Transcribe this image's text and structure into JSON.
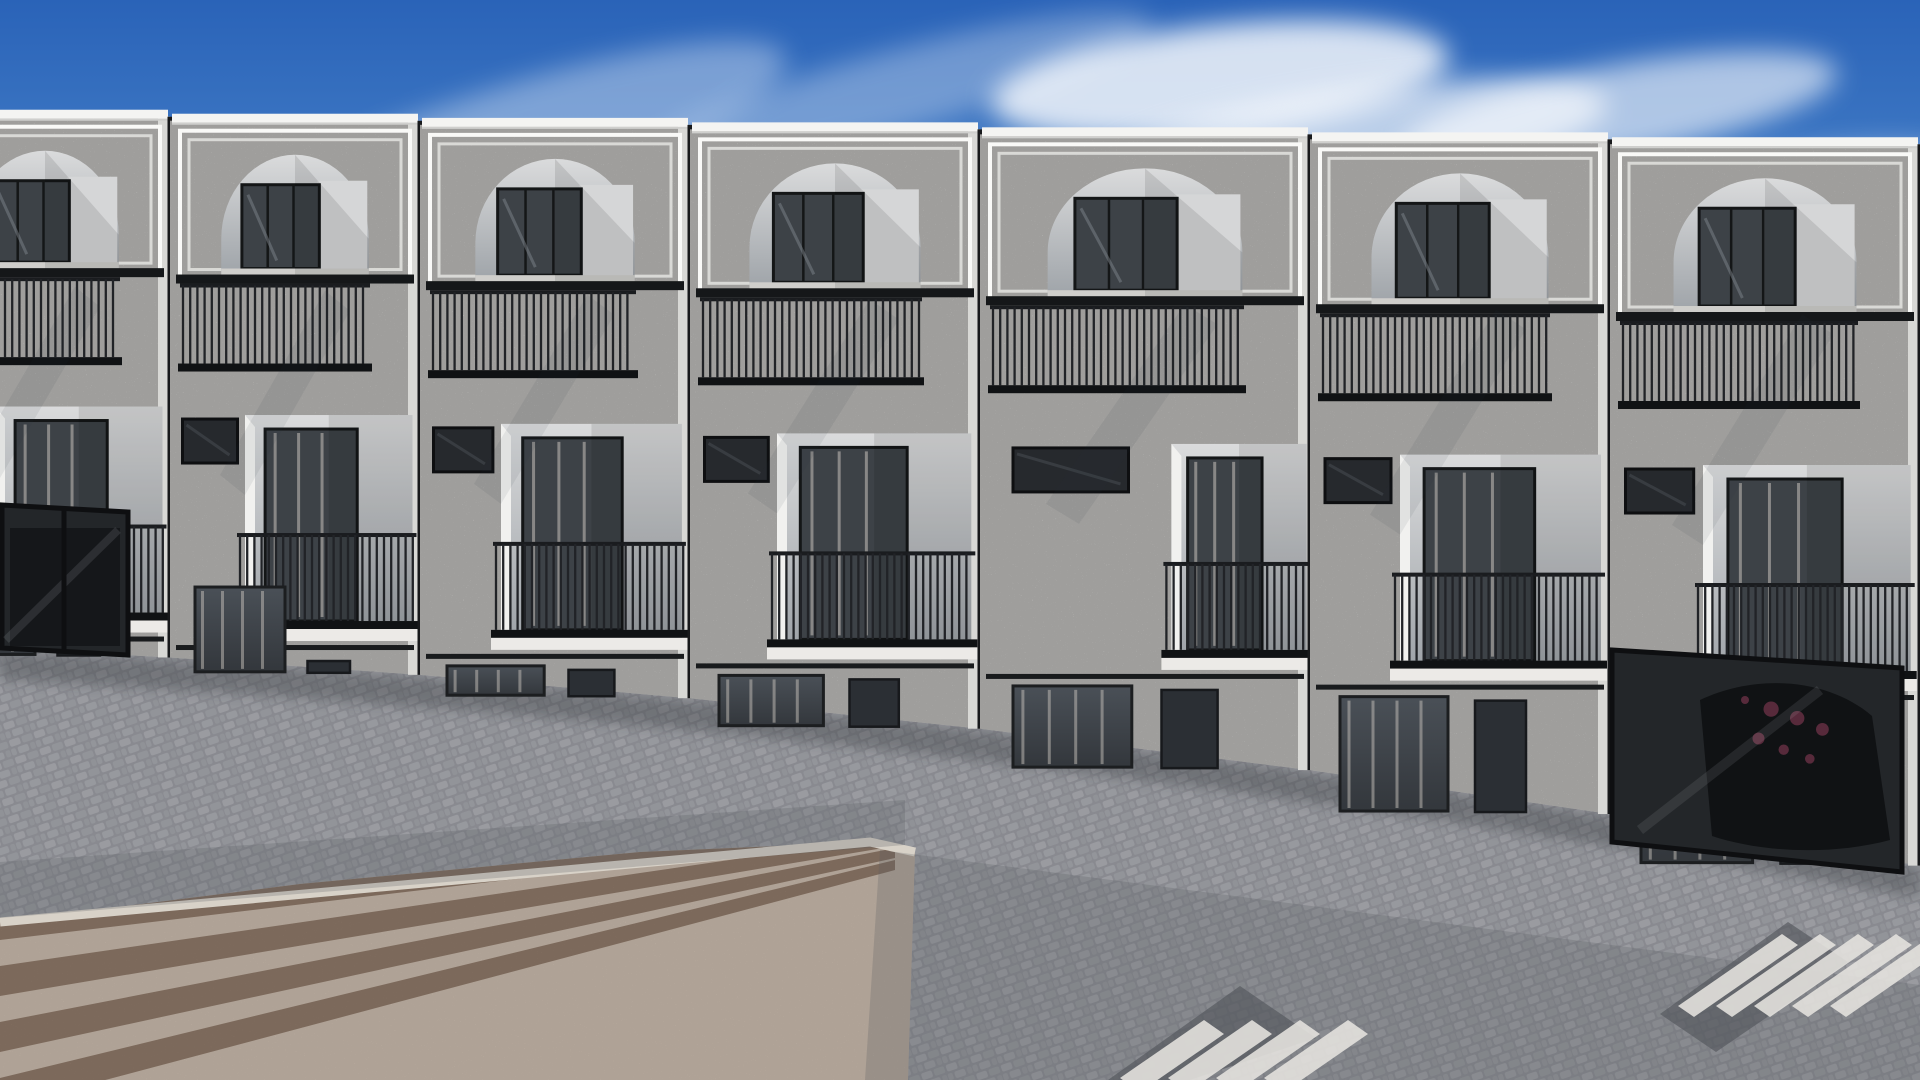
{
  "scene": {
    "description": "Aerial 3D architectural rendering: a row of white Mediterranean-style townhouses with arched roof terraces, black balcony railings, pink flowering trees, street lamps, parked cars, a cyclist and pedestrians on a paved street",
    "width": 1920,
    "height": 1080
  },
  "palette": {
    "sky_top": "#2a63b8",
    "sky_mid": "#4f8ace",
    "sky_horizon": "#a5c9ea",
    "cloud": "#ffffff",
    "facade": "#efeeeb",
    "facade_shade": "#d8d8d5",
    "facade_edge": "#f8f8f6",
    "recess_light": "#dadbdc",
    "recess_dark": "#9ea3a8",
    "glass": "#3d4247",
    "curtain": "#c6c1bb",
    "metal_black": "#17181b",
    "bar": "#212327",
    "cobble": "#8b8c92",
    "plaza_base": "#d7c7b8",
    "plaza_stripe": "#8d7463",
    "curb": "#d8d2c8",
    "foliage_greens": [
      "#5f8746",
      "#78a258",
      "#8fb36a"
    ],
    "blossom_pinks": [
      "#c9519f",
      "#e06cb8",
      "#ef9ed2"
    ],
    "trunk": "#6e5138",
    "shadow": "#24262b"
  },
  "sky": {
    "clouds": [
      {
        "cx": 500,
        "cy": 150,
        "rx": 300,
        "ry": 60,
        "o": 0.35,
        "rot": -18
      },
      {
        "cx": 700,
        "cy": 250,
        "rx": 340,
        "ry": 55,
        "o": 0.3,
        "rot": -16
      },
      {
        "cx": 380,
        "cy": 330,
        "rx": 260,
        "ry": 45,
        "o": 0.22,
        "rot": -14
      },
      {
        "cx": 900,
        "cy": 90,
        "rx": 260,
        "ry": 40,
        "o": 0.3,
        "rot": -15
      },
      {
        "cx": 1100,
        "cy": 220,
        "rx": 240,
        "ry": 35,
        "o": 0.25,
        "rot": -12
      },
      {
        "cx": 1220,
        "cy": 80,
        "rx": 230,
        "ry": 55,
        "o": 0.8,
        "rot": -6
      },
      {
        "cx": 1350,
        "cy": 140,
        "rx": 260,
        "ry": 50,
        "o": 0.65,
        "rot": -8
      },
      {
        "cx": 1620,
        "cy": 110,
        "rx": 220,
        "ry": 45,
        "o": 0.6,
        "rot": -10
      },
      {
        "cx": 1800,
        "cy": 180,
        "rx": 160,
        "ry": 30,
        "o": 0.35,
        "rot": -8
      },
      {
        "cx": 80,
        "cy": 200,
        "rx": 140,
        "ry": 35,
        "o": 0.25,
        "rot": -15
      }
    ]
  },
  "buildings": {
    "units": [
      {
        "x": -80,
        "w": 250,
        "tall": true
      },
      {
        "x": 170,
        "w": 250,
        "tall": true
      },
      {
        "x": 420,
        "w": 270,
        "tall": false
      },
      {
        "x": 690,
        "w": 290,
        "tall": false
      },
      {
        "x": 980,
        "w": 330,
        "tall": false,
        "rl": 0.58,
        "rr": 0.99,
        "sl": 0.1,
        "sr": 0.45
      },
      {
        "x": 1310,
        "w": 300,
        "tall": false
      },
      {
        "x": 1610,
        "w": 310,
        "tall": false
      }
    ]
  },
  "garages": [
    {
      "id": "garage-glass-left",
      "top": [
        2,
        505,
        128,
        512
      ],
      "bottom": [
        2,
        648,
        128,
        655
      ],
      "mullion": 64
    },
    {
      "id": "garage-glass-right",
      "top": [
        1612,
        650,
        1902,
        668
      ],
      "bottom": [
        1612,
        842,
        1902,
        872
      ],
      "mullion": 1694
    }
  ],
  "lamps": [
    {
      "x": 234,
      "base": 905,
      "top": 640
    },
    {
      "x": 571,
      "base": 878,
      "top": 650
    },
    {
      "x": 962,
      "base": 948,
      "top": 678
    }
  ],
  "trees": [
    {
      "id": "tree-1",
      "cx": 75,
      "cy": 465,
      "rx": 105,
      "ry": 92,
      "blobs": 16,
      "trunk": "M60,700 C66,640 60,585 75,525 M68,612 C95,585 108,560 112,540 M66,630 C40,600 30,575 28,560",
      "pit": [
        28,
        694,
        86,
        20
      ]
    },
    {
      "id": "tree-2",
      "cx": 258,
      "cy": 525,
      "rx": 115,
      "ry": 96,
      "blobs": 18,
      "behind_cars": true,
      "trunk": "M282,742 C278,700 270,660 262,610 M268,648 C240,615 228,592 224,575 M270,632 C300,600 316,578 320,560"
    },
    {
      "id": "tree-3",
      "cx": 600,
      "cy": 555,
      "rx": 125,
      "ry": 108,
      "blobs": 20,
      "trunk": "M612,795 C606,735 596,680 588,625 M598,690 C560,650 545,628 540,610 M600,668 C640,630 658,606 662,588",
      "pit": [
        570,
        788,
        84,
        20
      ]
    },
    {
      "id": "tree-4",
      "cx": 840,
      "cy": 560,
      "rx": 105,
      "ry": 95,
      "blobs": 18,
      "trunk": "M1000,932 C975,845 930,720 880,630 M940,750 C905,710 890,688 884,668 M958,790 C990,760 1006,738 1010,720",
      "pit": [
        958,
        925,
        84,
        20
      ]
    },
    {
      "id": "tree-5",
      "cx": 1205,
      "cy": 628,
      "rx": 128,
      "ry": 110,
      "blobs": 19,
      "trunk": "M1218,988 C1214,905 1210,790 1205,700 M1212,800 C1180,765 1165,742 1160,722 M1214,772 C1248,738 1262,715 1266,695",
      "pit": [
        1175,
        982,
        86,
        20
      ]
    },
    {
      "id": "tree-6",
      "cx": 1892,
      "cy": 640,
      "rx": 85,
      "ry": 95,
      "blobs": 12,
      "trunk": "M1895,870 C1893,800 1890,735 1888,700"
    }
  ],
  "cars": [
    {
      "id": "parked-car-edge-left",
      "type": "fragment",
      "x": -34,
      "y": 616,
      "angle": -12
    },
    {
      "id": "car-audi-a6",
      "label": "champagne sedan",
      "x": -15,
      "y": 700,
      "angle": -16,
      "len": 240,
      "wid": 95,
      "body": [
        "#d6cdbd",
        "#9a9184"
      ],
      "roof": "#d9d1c2",
      "facing": "front",
      "plate": "",
      "brand": "audi"
    },
    {
      "id": "car-range-rover-evoque",
      "label": "red SUV",
      "x": 242,
      "y": 690,
      "angle": -16,
      "len": 260,
      "wid": 108,
      "body": [
        "#de3a42",
        "#7e1016"
      ],
      "roof": "#dadbd8",
      "facing": "rear",
      "tail": "#5e0d12",
      "plate": "vizpeople",
      "badge": "RANGE ROVER",
      "bumperLight": true
    },
    {
      "id": "car-peugeot-508",
      "label": "silver sedan",
      "x": 593,
      "y": 723,
      "angle": -19,
      "len": 225,
      "wid": 102,
      "body": [
        "#d3d0ca",
        "#8e8b85"
      ],
      "roof": "#c9c6c0",
      "facing": "front",
      "plate": "vizpeople",
      "plateDark": true,
      "brand": "peugeot"
    },
    {
      "id": "car-audi-q7",
      "label": "white SUV",
      "x": 998,
      "y": 795,
      "angle": -19,
      "len": 255,
      "wid": 120,
      "body": [
        "#efece4",
        "#c5c1b6"
      ],
      "roof": "#e7e4db",
      "facing": "rear",
      "tail": "#c03028",
      "plate": "",
      "brand": "audi",
      "roofRails": true
    },
    {
      "id": "car-audi-a4",
      "label": "sage sedan",
      "x": 1292,
      "y": 835,
      "angle": -20,
      "len": 230,
      "wid": 104,
      "body": [
        "#c4c2b0",
        "#8f8d7e"
      ],
      "roof": "#b5b3a1",
      "facing": "front",
      "plate": "CO CK937",
      "brand": "audi",
      "flowerReflections": true
    },
    {
      "id": "car-sedan-bottom-right",
      "label": "champagne sedan",
      "x": 1738,
      "y": 858,
      "angle": 40,
      "len": 235,
      "wid": 100,
      "body": [
        "#c9c0b0",
        "#97907f"
      ],
      "roof": "#bdb4a4",
      "facing": "rear",
      "rearAtFar": true,
      "tail": "#a31f1f",
      "plate": ""
    }
  ],
  "people": [
    {
      "id": "person-woman-balcony",
      "type": "stand-f",
      "x": 513,
      "footY": 582,
      "skin": "#c99b7e",
      "hair": "#3a2a20",
      "top": "#eceae5",
      "bottom": "#2b3140"
    },
    {
      "id": "person-man-phone",
      "type": "stand-m",
      "x": 974,
      "footY": 558,
      "skin": "#c99b7e",
      "hair": "#6b4632",
      "top": "#c3c6c8",
      "bottom": "#565a61"
    },
    {
      "id": "person-woman-seated",
      "type": "seated",
      "x": 1288,
      "y": 556,
      "skin": "#c28a6d",
      "hair": "#2f2018",
      "dress": "#ee4f3c",
      "cardigan": "#2c3752"
    },
    {
      "id": "person-pedestrian",
      "type": "walker",
      "x": 338,
      "footY": 862,
      "skin": "#b98a68",
      "hair": "#241a12",
      "jacket": "#5f83b0",
      "pack": "#d9d2c2",
      "jeans": "#46678f"
    },
    {
      "id": "person-cyclist",
      "type": "cyclist",
      "headX": 1262,
      "headY": 884,
      "shirt": "#4f7fc1",
      "jeans": "#3c4a66",
      "skin": "#c99b7e",
      "hair": "#8a6b4f",
      "bike": "#2e7ca8",
      "rearWheel": [
        1237,
        1016
      ],
      "frontWheel": [
        1318,
        1028
      ],
      "r": 27
    }
  ],
  "furniture": {
    "acapulco_chairs": [
      {
        "cx": 597,
        "cy": 492
      },
      {
        "cx": 657,
        "cy": 494
      }
    ],
    "acapulco_cushion": "#7fa9cb",
    "egg_chair": {
      "cx": 906,
      "topY": 412,
      "eggCy": 488,
      "rattan": "#8a6a3e",
      "pillow": "#4f8fd0"
    },
    "seated_chairs": [
      {
        "cx": 1290,
        "cy": 560,
        "cushion": "#3a3e44"
      },
      {
        "cx": 1350,
        "cy": 558,
        "cushion": "#d9d6d0"
      }
    ]
  },
  "planters": [
    {
      "x": 8,
      "y": 424,
      "w": 34
    },
    {
      "x": 1124,
      "y": 428,
      "w": 40
    },
    {
      "x": 1632,
      "y": 520,
      "w": 40
    }
  ],
  "ground": {
    "plaza": {
      "points": "0,922 300,884 640,852 870,842 915,852 908,1080 0,1080",
      "stripes": 7
    },
    "curb": "M 0,922 L 870,842 L 915,852",
    "lane_shades": [
      "0,862 905,800 905,845 0,918",
      "880,850 1920,985 1920,1080 865,1080"
    ],
    "crosswalks": [
      {
        "dark": "1108,1080 1240,986 1316,1038 1190,1080",
        "n": 4,
        "x0": 1120,
        "dx": 48,
        "y0": 1078,
        "vx": 84,
        "vy": -58,
        "tx": 20,
        "ty": 14
      },
      {
        "dark": "1660,1014 1788,922 1848,962 1716,1052",
        "n": 5,
        "x0": 1678,
        "dx": 38,
        "y0": 1006,
        "vx": 104,
        "vy": -72,
        "tx": 16,
        "ty": 11
      }
    ],
    "long_shadow": "618,854 668,846 1452,1010 1368,1044",
    "ped_shadow": {
      "cx": 432,
      "cy": 888,
      "rx": 74,
      "ry": 13,
      "rot": 11
    },
    "tree_shadows": [
      {
        "cx": 180,
        "cy": 737,
        "rx": 110,
        "ry": 24
      },
      {
        "cx": 436,
        "cy": 782,
        "rx": 130,
        "ry": 26
      },
      {
        "cx": 762,
        "cy": 812,
        "rx": 150,
        "ry": 30
      },
      {
        "cx": 1022,
        "cy": 948,
        "rx": 120,
        "ry": 26
      },
      {
        "cx": 1332,
        "cy": 1008,
        "rx": 140,
        "ry": 28
      }
    ]
  }
}
